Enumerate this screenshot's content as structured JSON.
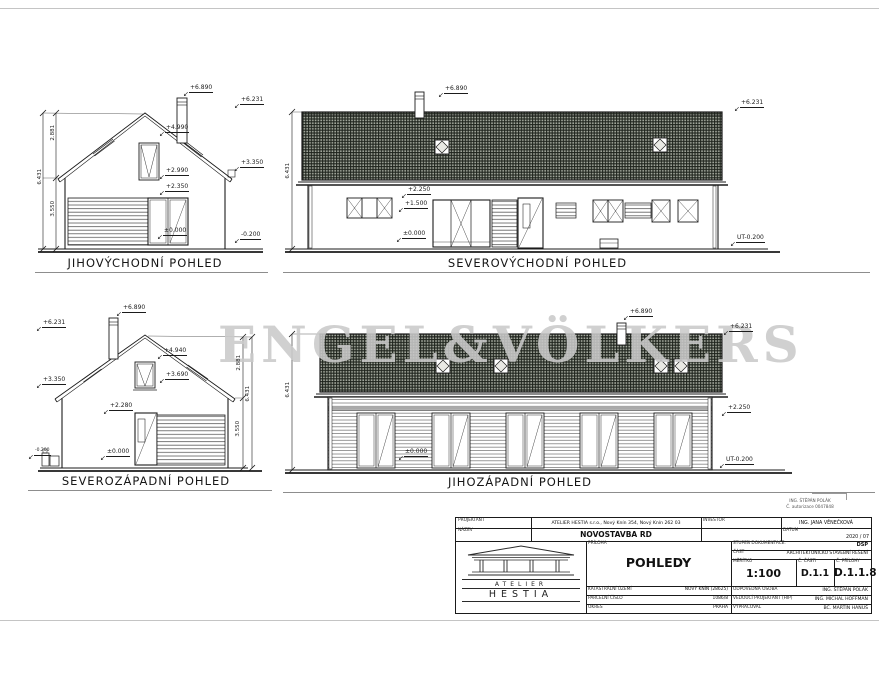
{
  "sheet": {
    "watermark": "ENGEL&VÖLKERS"
  },
  "note": {
    "line1": "ING. ŠTĚPÁN POLÁK",
    "line2": "Č. autorizace 0047848"
  },
  "elev_jv": {
    "caption": "JIHOVÝCHODNÍ POHLED",
    "chimney_top": "+6.890",
    "ridge": "+6.231",
    "mid": "+4.990",
    "eaves": "+3.350",
    "win_top": "+2.990",
    "lintel": "+2.350",
    "floor": "±0.000",
    "terrain": "-0.200",
    "dim_upper": "2.881",
    "dim_total": "6.431",
    "dim_lower": "3.550"
  },
  "elev_sv": {
    "caption": "SEVEROVÝCHODNÍ POHLED",
    "chimney_top": "+6.890",
    "ridge": "+6.231",
    "lintel": "+2.250",
    "sill": "+1.500",
    "floor": "±0.000",
    "terrain": "UT-0.200",
    "dim_total": "6.431"
  },
  "elev_sz": {
    "caption": "SEVEROZÁPADNÍ POHLED",
    "chimney_top": "+6.890",
    "ridge": "+6.231",
    "eaves": "+3.350",
    "win_top": "+4.940",
    "win_sill": "+3.690",
    "lintel": "+2.280",
    "floor": "±0.000",
    "terrain": "-0.200",
    "dim_upper": "2.881",
    "dim_total": "6.431",
    "dim_lower": "3.550"
  },
  "elev_jz": {
    "caption": "JIHOZÁPADNÍ POHLED",
    "chimney_top": "+6.890",
    "ridge": "+6.231",
    "eaves": "+2.250",
    "floor": "±0.000",
    "terrain": "UT-0.200",
    "dim_total": "6.431"
  },
  "titleblock": {
    "labels": {
      "projektant": "PROJEKTANT",
      "nazev": "NÁZEV",
      "investor": "INVESTOR",
      "datum": "DATUM",
      "priloha": "PŘÍLOHA",
      "stupen": "STUPEŇ DOKUMENTACE.",
      "cast": "ČÁST",
      "meritko": "MĚŘÍTKO",
      "c_casti": "Č. ČÁSTI",
      "c_prilohy": "Č. PŘÍLOHY",
      "katastr": "KATASTRÁLNÍ ÚZEMÍ",
      "parcela": "PARCELNÍ ČÍSLO",
      "okres": "OKRES",
      "odpovedna": "ODPOVĚDNÁ OSOBA",
      "vedouci": "VEDOUCÍ PROJEKTANT (HIP)",
      "vypracoval": "VYPRACOVAL"
    },
    "values": {
      "address": "ATELIER HESTIA s.r.o., Nový Knín 354, Nový Knín 262 03",
      "investor": "ING. JANA VĚNEČKOVÁ",
      "nazev": "NOVOSTAVBA RD",
      "datum": "2020 / 07",
      "priloha": "POHLEDY",
      "stupen": "DSP",
      "cast": "ARCHITEKTONICKO STAVEBNÍ ŘEŠENÍ",
      "meritko": "1:100",
      "c_casti": "D.1.1",
      "c_prilohy": "D.1.1.8",
      "katastr": "NOVÝ KNÍN (28625)",
      "parcela": "1086/8",
      "okres": "PRAHA",
      "odpovedna": "ING. ŠTĚPÁN POLÁK",
      "vedouci": "ING. MICHAL HOFFMAN",
      "vypracoval": "BC. MARTIN HANUŠ"
    },
    "logo": {
      "line1": "ATELIER",
      "line2": "HESTIA"
    }
  },
  "colors": {
    "roof_hatch": "#565b50",
    "line": "#1b1b1b",
    "watermark": "#c9c9c9"
  }
}
